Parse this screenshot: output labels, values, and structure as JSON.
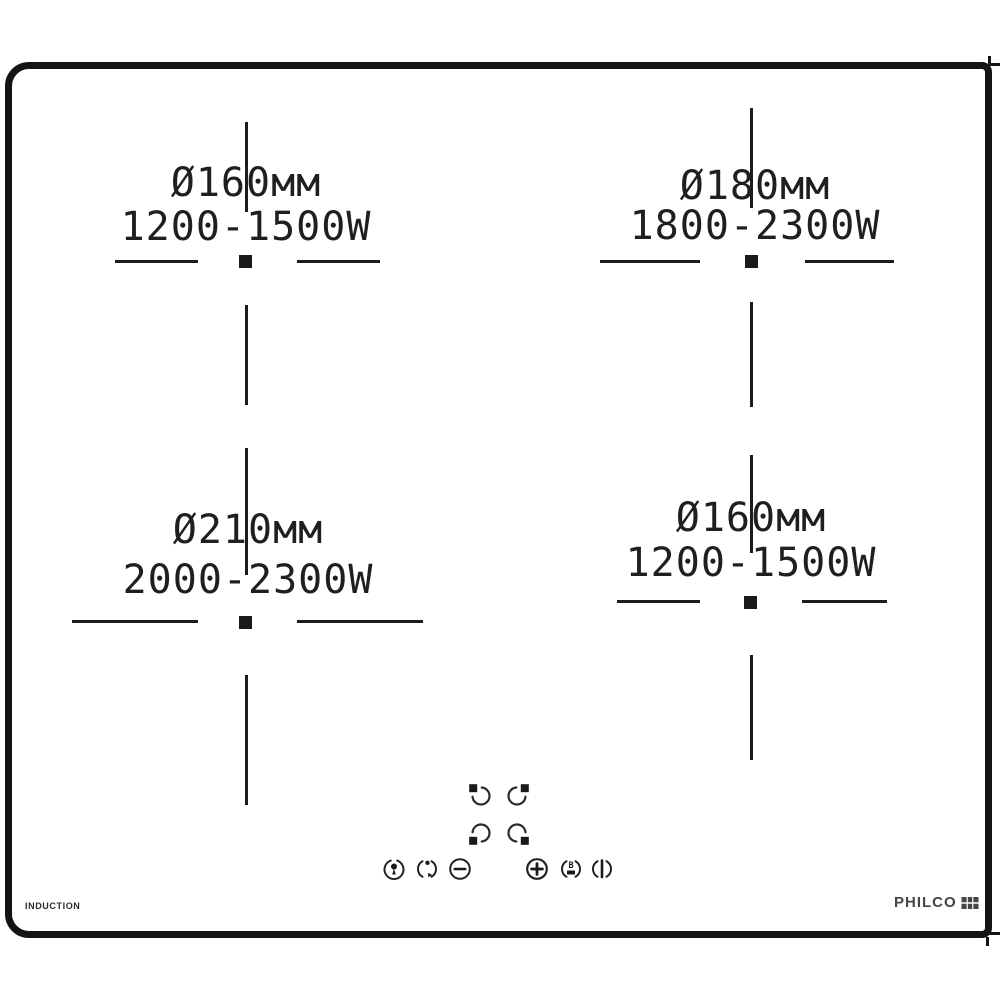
{
  "product": {
    "brand": "PHILCO",
    "type_label": "INDUCTION"
  },
  "zones": [
    {
      "position": "top-left",
      "diameter": "Ø160мм",
      "power": "1200-1500W"
    },
    {
      "position": "top-right",
      "diameter": "Ø180мм",
      "power": "1800-2300W"
    },
    {
      "position": "bottom-left",
      "diameter": "Ø210мм",
      "power": "2000-2300W"
    },
    {
      "position": "bottom-right",
      "diameter": "Ø160мм",
      "power": "1200-1500W"
    }
  ],
  "controls": {
    "zone_selectors": [
      {
        "icon": "zone-select-top-left-icon"
      },
      {
        "icon": "zone-select-top-right-icon"
      },
      {
        "icon": "zone-select-bottom-left-icon"
      },
      {
        "icon": "zone-select-bottom-right-icon"
      }
    ],
    "button_icons": [
      "child-lock-icon",
      "timer-icon",
      "minus-icon",
      "plus-icon",
      "booster-icon",
      "power-icon"
    ],
    "booster_letter": "B"
  },
  "colors": {
    "ink": "#1c1c1c",
    "border": "#141414",
    "brand_gray": "#454545",
    "background": "#ffffff"
  }
}
